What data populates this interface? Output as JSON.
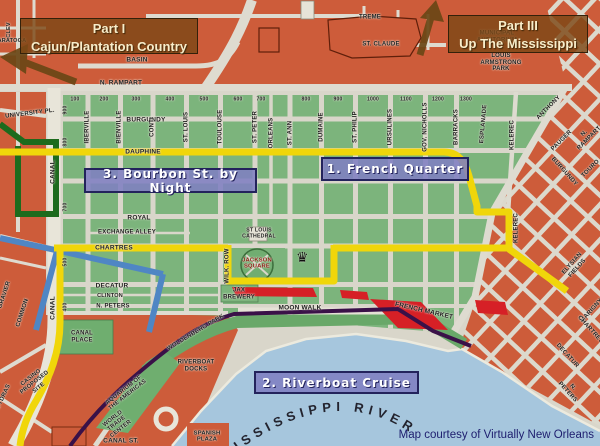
{
  "overlays": {
    "part1": {
      "line1": "Part I",
      "line2": "Cajun/Plantation Country"
    },
    "part3": {
      "line1": "Part III",
      "line2": "Up The Mississippi"
    },
    "stop1": "1. French Quarter",
    "stop2": "2. Riverboat Cruise",
    "stop3": "3. Bourbon St. by Night",
    "credit": "Map courtesy of Virtually New Orleans"
  },
  "map": {
    "river_label": "MISSISSIPPI RIVER",
    "crown": "♛",
    "colors": {
      "block_green": "#7cb47c",
      "block_orange": "#cd5c3a",
      "route_yellow": "#f0d60a",
      "route_blue": "#4f86c4",
      "route_green": "#1d6b1d",
      "river_blue": "#a6c6dd",
      "streetcar_purple": "#3a1148",
      "market_red": "#d62026",
      "label_box_purple": "#8080c2",
      "label_box_brown": "#7c4816"
    },
    "labels": [
      {
        "t": "TREME",
        "x": 370,
        "y": 18,
        "r": 0,
        "s": 6
      },
      {
        "t": "ST. CLAUDE",
        "x": 381,
        "y": 45,
        "r": 0,
        "s": 6
      },
      {
        "t": "MUNICIPAL\nAUDITORIUM",
        "x": 497,
        "y": 37,
        "r": 0,
        "s": 6
      },
      {
        "t": "LOUIS\nARMSTRONG\nPARK",
        "x": 501,
        "y": 63,
        "r": 0,
        "s": 6
      },
      {
        "t": "BASIN",
        "x": 137,
        "y": 60,
        "r": 0,
        "s": 6.5
      },
      {
        "t": "N. RAMPART",
        "x": 121,
        "y": 83,
        "r": 0,
        "s": 6.5
      },
      {
        "t": "UNIVERSITY PL.",
        "x": 30,
        "y": 114,
        "r": -7,
        "s": 6
      },
      {
        "t": "BURGUNDY",
        "x": 146,
        "y": 120,
        "r": 0,
        "s": 6.5
      },
      {
        "t": "DAUPHINE",
        "x": 143,
        "y": 152,
        "r": 0,
        "s": 6.5
      },
      {
        "t": "ROYAL",
        "x": 139,
        "y": 218,
        "r": 0,
        "s": 6.5
      },
      {
        "t": "EXCHANGE ALLEY",
        "x": 127,
        "y": 233,
        "r": 0,
        "s": 6
      },
      {
        "t": "CHARTRES",
        "x": 114,
        "y": 248,
        "r": 0,
        "s": 6.5
      },
      {
        "t": "DECATUR",
        "x": 112,
        "y": 286,
        "r": 0,
        "s": 6.5
      },
      {
        "t": "CLINTON",
        "x": 110,
        "y": 296,
        "r": 0,
        "s": 5.5
      },
      {
        "t": "N. PETERS",
        "x": 113,
        "y": 307,
        "r": 0,
        "s": 6
      },
      {
        "t": "CANAL",
        "x": 53,
        "y": 172,
        "r": -90,
        "s": 6.5
      },
      {
        "t": "CANAL",
        "x": 53,
        "y": 308,
        "r": -90,
        "s": 6.5
      },
      {
        "t": "COMMON",
        "x": 23,
        "y": 313,
        "r": -72,
        "s": 6
      },
      {
        "t": "GRAVIER",
        "x": 5,
        "y": 295,
        "r": -72,
        "s": 6
      },
      {
        "t": "POYDRAS",
        "x": 3,
        "y": 399,
        "r": -65,
        "s": 6
      },
      {
        "t": "CLEV",
        "x": 9,
        "y": 30,
        "r": -90,
        "s": 5.5
      },
      {
        "t": "SARATOGA",
        "x": 10,
        "y": 41,
        "r": 0,
        "s": 5.5
      },
      {
        "t": "IBERVILLE",
        "x": 88,
        "y": 127,
        "r": -90,
        "s": 6
      },
      {
        "t": "BIENVILLE",
        "x": 120,
        "y": 127,
        "r": -90,
        "s": 6
      },
      {
        "t": "CONTI",
        "x": 153,
        "y": 127,
        "r": -90,
        "s": 6
      },
      {
        "t": "ST. LOUIS",
        "x": 187,
        "y": 127,
        "r": -90,
        "s": 6
      },
      {
        "t": "TOULOUSE",
        "x": 221,
        "y": 127,
        "r": -90,
        "s": 6
      },
      {
        "t": "ST. PETER",
        "x": 256,
        "y": 127,
        "r": -90,
        "s": 6
      },
      {
        "t": "ORLEANS",
        "x": 272,
        "y": 133,
        "r": -90,
        "s": 6
      },
      {
        "t": "ST. ANN",
        "x": 291,
        "y": 133,
        "r": -90,
        "s": 6
      },
      {
        "t": "DUMAINE",
        "x": 322,
        "y": 127,
        "r": -90,
        "s": 6
      },
      {
        "t": "ST. PHILIP",
        "x": 356,
        "y": 127,
        "r": -90,
        "s": 6
      },
      {
        "t": "URSULINES",
        "x": 391,
        "y": 127,
        "r": -90,
        "s": 6
      },
      {
        "t": "GOV. NICHOLLS",
        "x": 426,
        "y": 127,
        "r": -90,
        "s": 6
      },
      {
        "t": "BARRACKS",
        "x": 457,
        "y": 127,
        "r": -90,
        "s": 6
      },
      {
        "t": "ESPLANADE",
        "x": 484,
        "y": 124,
        "r": -85,
        "s": 6
      },
      {
        "t": "KELEREC",
        "x": 513,
        "y": 135,
        "r": -90,
        "s": 6
      },
      {
        "t": "KELEREC",
        "x": 517,
        "y": 228,
        "r": -90,
        "s": 6
      },
      {
        "t": "WILK. ROW",
        "x": 228,
        "y": 266,
        "r": -90,
        "s": 6
      },
      {
        "t": "ANTHONY",
        "x": 549,
        "y": 108,
        "r": -45,
        "s": 6
      },
      {
        "t": "PAUGER",
        "x": 562,
        "y": 141,
        "r": -45,
        "s": 6
      },
      {
        "t": "N. RAMPART",
        "x": 587,
        "y": 136,
        "r": -45,
        "s": 6
      },
      {
        "t": "BURGUNDY",
        "x": 564,
        "y": 172,
        "r": 48,
        "s": 6
      },
      {
        "t": "TOURO",
        "x": 591,
        "y": 169,
        "r": -45,
        "s": 6
      },
      {
        "t": "ELYSIAN FIELDS",
        "x": 575,
        "y": 266,
        "r": -48,
        "s": 6
      },
      {
        "t": "MARIGNY",
        "x": 592,
        "y": 311,
        "r": -48,
        "s": 6
      },
      {
        "t": "CHARTRES",
        "x": 590,
        "y": 330,
        "r": 48,
        "s": 6
      },
      {
        "t": "DECATUR",
        "x": 567,
        "y": 356,
        "r": 48,
        "s": 6
      },
      {
        "t": "N. PETERS",
        "x": 570,
        "y": 390,
        "r": 48,
        "s": 6
      },
      {
        "t": "ST LOUIS\nCATHEDRAL",
        "x": 259,
        "y": 234,
        "r": 0,
        "s": 5.2
      },
      {
        "t": "JACKSON\nSQUARE",
        "x": 257,
        "y": 264,
        "r": 0,
        "s": 5.8,
        "c": "#8b1a12"
      },
      {
        "t": "JAX\nBREWERY",
        "x": 239,
        "y": 294,
        "r": 0,
        "s": 6
      },
      {
        "t": "MOON WALK",
        "x": 300,
        "y": 308,
        "r": 0,
        "s": 6.5
      },
      {
        "t": "WOLDENBERG PARK",
        "x": 196,
        "y": 333,
        "r": -31,
        "s": 6
      },
      {
        "t": "RIVERBOAT\nDOCKS",
        "x": 196,
        "y": 366,
        "r": 0,
        "s": 6
      },
      {
        "t": "FRENCH MARKET",
        "x": 424,
        "y": 311,
        "r": 13,
        "s": 6.5
      },
      {
        "t": "CANAL\nPLACE",
        "x": 82,
        "y": 337,
        "r": 0,
        "s": 6
      },
      {
        "t": "CASINO\nPROPOSED\nSITE",
        "x": 35,
        "y": 383,
        "r": -38,
        "s": 5.8
      },
      {
        "t": "AQUARIUM OF\nTHE AMERICAS",
        "x": 126,
        "y": 393,
        "r": -38,
        "s": 5.8
      },
      {
        "t": "WORLD\nTRADE\nCENTER",
        "x": 117,
        "y": 424,
        "r": -38,
        "s": 5.8
      },
      {
        "t": "SPANISH\nPLAZA",
        "x": 207,
        "y": 437,
        "r": 0,
        "s": 5.8
      },
      {
        "t": "CANAL ST.",
        "x": 121,
        "y": 441,
        "r": 0,
        "s": 6.5
      },
      {
        "t": "100",
        "x": 75,
        "y": 100,
        "r": 0,
        "s": 5
      },
      {
        "t": "200",
        "x": 104,
        "y": 100,
        "r": 0,
        "s": 5
      },
      {
        "t": "300",
        "x": 136,
        "y": 100,
        "r": 0,
        "s": 5
      },
      {
        "t": "400",
        "x": 170,
        "y": 100,
        "r": 0,
        "s": 5
      },
      {
        "t": "500",
        "x": 204,
        "y": 100,
        "r": 0,
        "s": 5
      },
      {
        "t": "600",
        "x": 238,
        "y": 100,
        "r": 0,
        "s": 5
      },
      {
        "t": "700",
        "x": 261,
        "y": 100,
        "r": 0,
        "s": 5
      },
      {
        "t": "800",
        "x": 306,
        "y": 100,
        "r": 0,
        "s": 5
      },
      {
        "t": "900",
        "x": 338,
        "y": 100,
        "r": 0,
        "s": 5
      },
      {
        "t": "1000",
        "x": 373,
        "y": 100,
        "r": 0,
        "s": 5
      },
      {
        "t": "1100",
        "x": 406,
        "y": 100,
        "r": 0,
        "s": 5
      },
      {
        "t": "1200",
        "x": 438,
        "y": 100,
        "r": 0,
        "s": 5
      },
      {
        "t": "1300",
        "x": 466,
        "y": 100,
        "r": 0,
        "s": 5
      },
      {
        "t": "900",
        "x": 66,
        "y": 110,
        "r": -90,
        "s": 5
      },
      {
        "t": "800",
        "x": 66,
        "y": 142,
        "r": -90,
        "s": 5
      },
      {
        "t": "700",
        "x": 66,
        "y": 207,
        "r": -90,
        "s": 5
      },
      {
        "t": "500",
        "x": 66,
        "y": 262,
        "r": -90,
        "s": 5
      },
      {
        "t": "400",
        "x": 66,
        "y": 307,
        "r": -90,
        "s": 5
      }
    ]
  }
}
